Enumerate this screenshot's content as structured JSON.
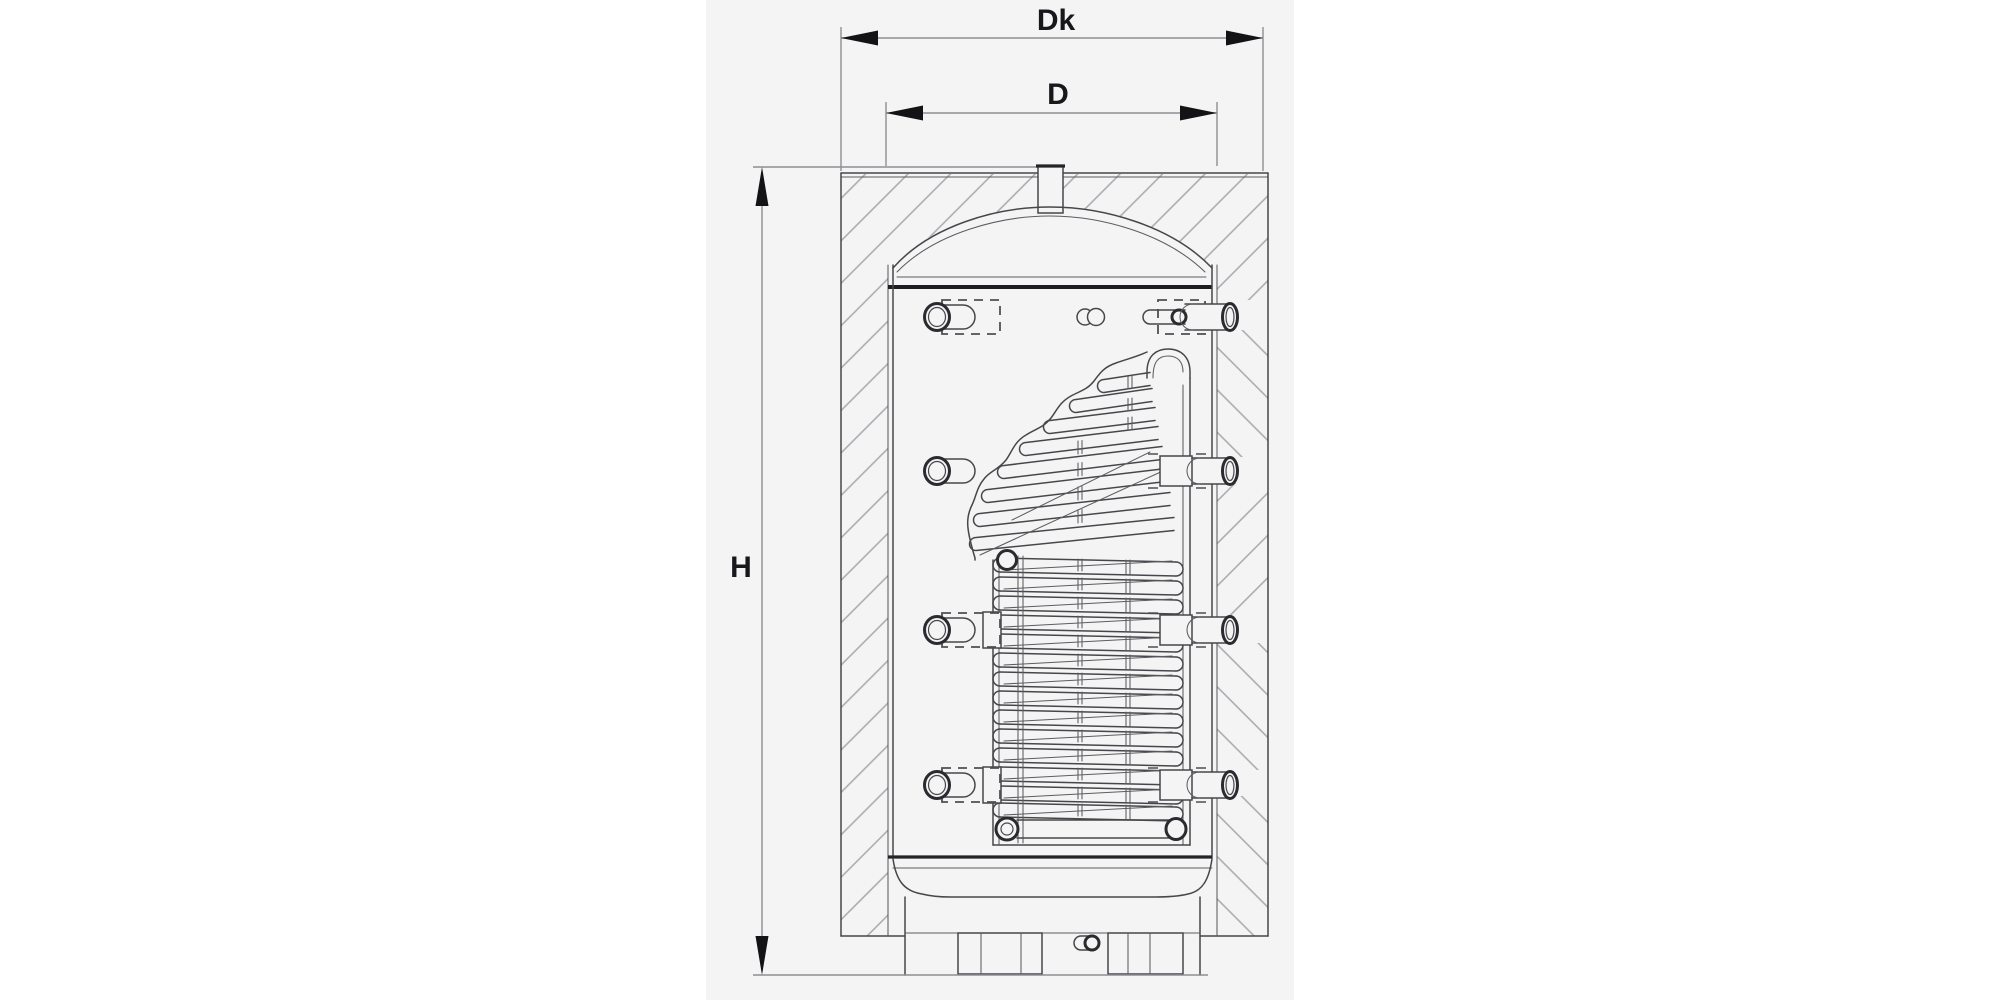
{
  "page": {
    "background": "#ffffff",
    "panel_background": "#f4f4f5"
  },
  "drawing": {
    "type": "technical-cross-section",
    "subject": "storage-tank-with-corrugated-coil-heat-exchanger"
  },
  "labels": {
    "outer_diameter_top": "Dk",
    "inner_diameter": "D",
    "height": "H"
  },
  "colors": {
    "outline": "#47474b",
    "weld_line": "#1d1d21",
    "hatch_line": "#a8a8ac",
    "dimension_line": "#8f8f94",
    "label_text": "#18181c"
  }
}
